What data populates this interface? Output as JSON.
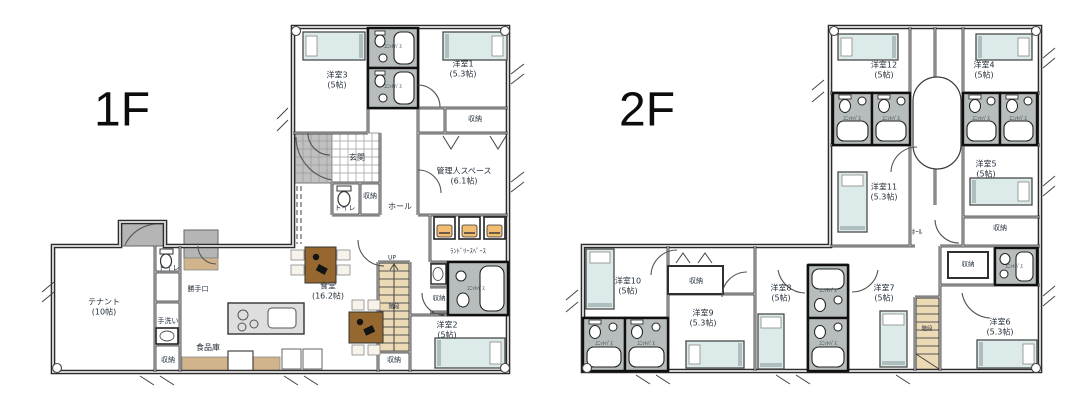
{
  "colors": {
    "wall": "#2b2b2b",
    "bed_fill": "#dcebe9",
    "unit_bath_fill": "#b7bdbd",
    "stairs_fill": "#ecd9b5",
    "wood_tan": "#d2b48c",
    "washer_accent": "#f0bd72",
    "table_brown": "#96682f",
    "tile_gray": "#c0c0c0"
  },
  "floor1": {
    "title": "1F",
    "rooms": {
      "youshitsu1": {
        "name": "洋室1",
        "size": "(5.3帖)"
      },
      "youshitsu2": {
        "name": "洋室2",
        "size": "(5帖)"
      },
      "youshitsu3": {
        "name": "洋室3",
        "size": "(5帖)"
      },
      "kanrinin": {
        "name": "管理人スペース",
        "size": "(6.1帖)"
      },
      "tenant": {
        "name": "テナント",
        "size": "(10帖)"
      },
      "dining": {
        "name": "食堂",
        "size": "(16.2帖)"
      },
      "genkan": "玄関",
      "hall": "ホール",
      "toilet": "トイレ",
      "closet": "収納",
      "laundry": "ﾗﾝﾄﾞﾘｰｽﾍﾟｰｽ",
      "unit_bath": "ﾕﾆｯﾄﾊﾞｽ",
      "stairs": "階段",
      "up": "UP",
      "backdoor": "勝手口",
      "handwash": "手洗い",
      "pantry": "食品庫"
    }
  },
  "floor2": {
    "title": "2F",
    "rooms": {
      "youshitsu4": {
        "name": "洋室4",
        "size": "(5帖)"
      },
      "youshitsu5": {
        "name": "洋室5",
        "size": "(5帖)"
      },
      "youshitsu6": {
        "name": "洋室6",
        "size": "(5.3帖)"
      },
      "youshitsu7": {
        "name": "洋室7",
        "size": "(5帖)"
      },
      "youshitsu8": {
        "name": "洋室8",
        "size": "(5帖)"
      },
      "youshitsu9": {
        "name": "洋室9",
        "size": "(5.3帖)"
      },
      "youshitsu10": {
        "name": "洋室10",
        "size": "(5帖)"
      },
      "youshitsu11": {
        "name": "洋室11",
        "size": "(5.3帖)"
      },
      "youshitsu12": {
        "name": "洋室12",
        "size": "(5帖)"
      },
      "hall": "ﾎｰﾙ",
      "closet": "収納",
      "unit_bath": "ﾕﾆｯﾄﾊﾞｽ",
      "stairs": "階段"
    }
  }
}
